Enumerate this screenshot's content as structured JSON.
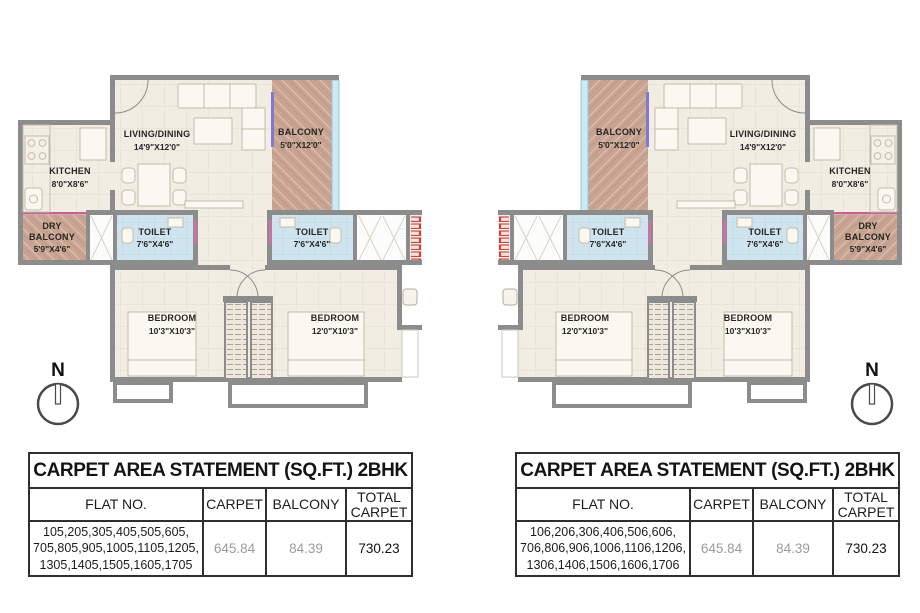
{
  "rooms": {
    "living": {
      "name": "LIVING/DINING",
      "dims": "14'9\"X12'0\""
    },
    "balcony": {
      "name": "BALCONY",
      "dims": "5'0\"X12'0\""
    },
    "kitchen": {
      "name": "KITCHEN",
      "dims": "8'0\"X8'6\""
    },
    "dry_balcony": {
      "line1": "DRY",
      "line2": "BALCONY",
      "dims": "5'9\"X4'6\""
    },
    "toilet": {
      "name": "TOILET",
      "dims": "7'6\"X4'6\""
    },
    "bedroom_small": {
      "name": "BEDROOM",
      "dims": "10'3\"X10'3\""
    },
    "bedroom_large": {
      "name": "BEDROOM",
      "dims": "12'0\"X10'3\""
    }
  },
  "north": {
    "label": "N"
  },
  "tables": {
    "left": {
      "title": "CARPET AREA STATEMENT (SQ.FT.) 2BHK",
      "headers": {
        "flat": "FLAT NO.",
        "carpet": "CARPET",
        "balcony": "BALCONY",
        "total": "TOTAL CARPET"
      },
      "row": {
        "flats_line1": "105,205,305,405,505,605,",
        "flats_line2": "705,805,905,1005,1105,1205,",
        "flats_line3": "1305,1405,1505,1605,1705",
        "carpet": "645.84",
        "balcony": "84.39",
        "total": "730.23"
      }
    },
    "right": {
      "title": "CARPET AREA STATEMENT (SQ.FT.) 2BHK",
      "headers": {
        "flat": "FLAT NO.",
        "carpet": "CARPET",
        "balcony": "BALCONY",
        "total": "TOTAL CARPET"
      },
      "row": {
        "flats_line1": "106,206,306,406,506,606,",
        "flats_line2": "706,806,906,1006,1106,1206,",
        "flats_line3": "1306,1406,1506,1606,1706",
        "carpet": "645.84",
        "balcony": "84.39",
        "total": "730.23"
      }
    }
  },
  "colors": {
    "wall": "#8c8c8c",
    "floor": "#f2ede3",
    "balcony_fill": "#c9a492",
    "toilet_fill": "#cfe4ee",
    "glass": "#cde9f2",
    "accent_magenta": "#c2628e",
    "accent_purple": "#8377d6",
    "window_red": "#c4473d",
    "table_border": "#2f2f2f"
  }
}
